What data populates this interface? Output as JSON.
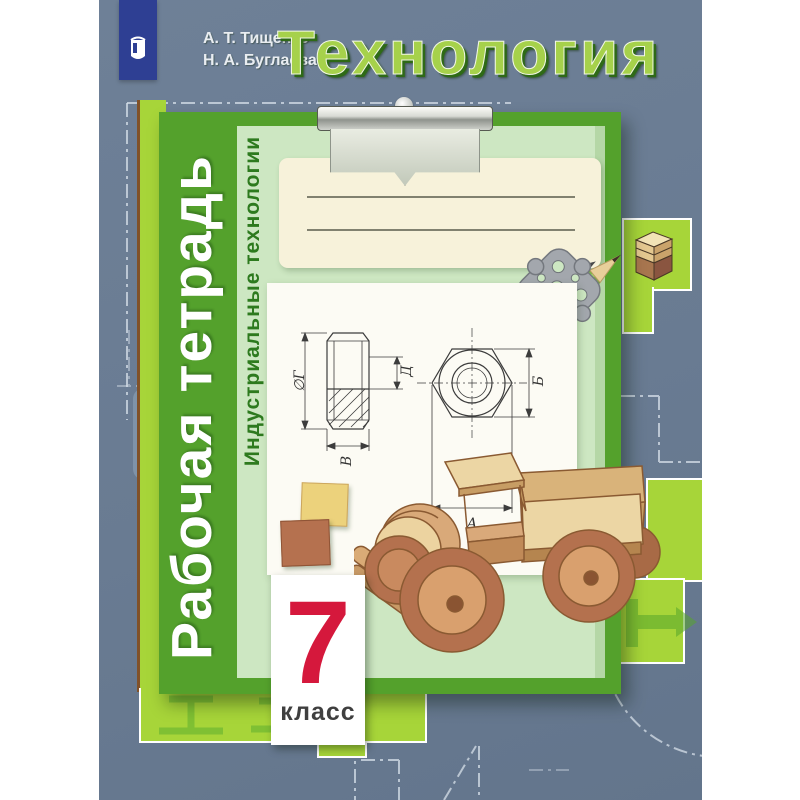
{
  "cover": {
    "authors": {
      "line1": "А. Т. Тищенко",
      "line2": "Н. А. Буглаева"
    },
    "title": "Технология",
    "workbook_label": "Рабочая тетрадь",
    "subtitle": "Индустриальные технологии",
    "grade": {
      "number": "7",
      "label": "класс"
    }
  },
  "drawing": {
    "dims": {
      "diameter_g": "∅Г",
      "d": "Д",
      "v": "В",
      "b": "Б",
      "a": "А"
    }
  },
  "icons": {
    "publisher_emblem": "prosveshchenie-emblem",
    "clipboard_clip": "metal-clip",
    "plywood_stack": "plywood-layers-block",
    "metal_ornament": "openwork-metal-plate",
    "pencils": "two-pencils",
    "toy_truck": "wooden-toy-truck",
    "chisel": "chisel-silhouette"
  },
  "colors": {
    "background_blue": "#6b7d94",
    "board_green": "#54a12c",
    "board_face_green": "#cde7c2",
    "lime_green": "#a7d539",
    "title_green": "#a6d14b",
    "accent_red": "#d5183c",
    "logo_blue": "#2e3f93",
    "paper_cream": "#f7f2da"
  }
}
